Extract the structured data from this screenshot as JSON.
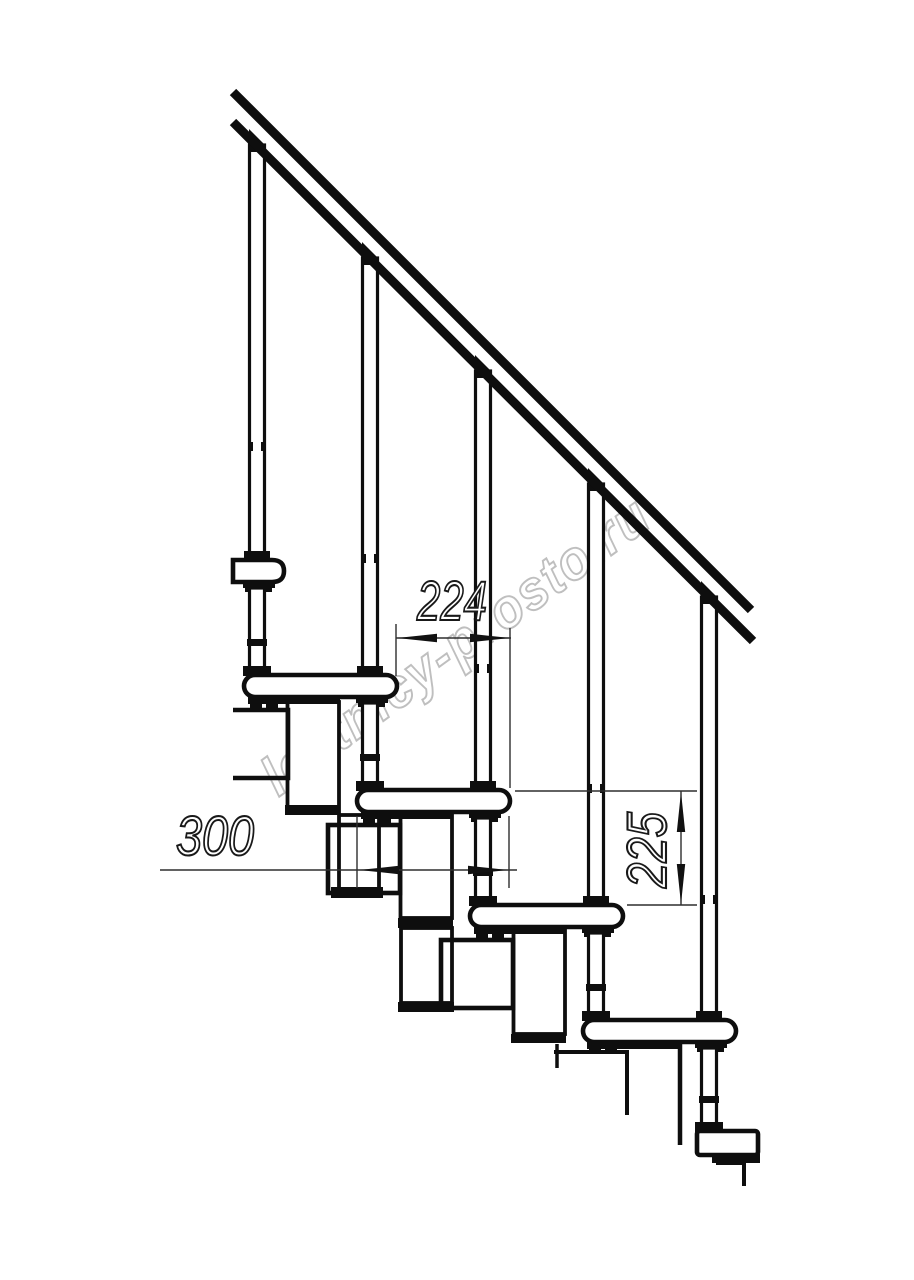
{
  "title": "Modular staircase side-view technical drawing",
  "watermark": {
    "text": "lestnicy-prosto.ru"
  },
  "dimensions": {
    "going_label": "224",
    "tread_length_label": "300",
    "rise_label": "225",
    "units": "mm"
  },
  "parts": {
    "handrail": "handrail",
    "balusters": [
      "baluster-1",
      "baluster-2",
      "baluster-3",
      "baluster-4",
      "baluster-5"
    ],
    "treads": [
      "tread-1",
      "tread-2",
      "tread-3",
      "tread-4",
      "tread-5"
    ],
    "modules": [
      "module-2",
      "module-3",
      "module-4",
      "module-5"
    ],
    "floor_mount": "floor-mount-block"
  }
}
